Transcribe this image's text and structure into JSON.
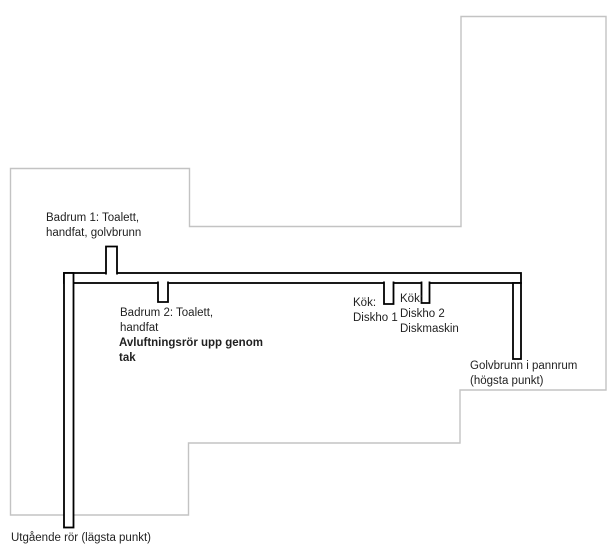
{
  "diagram": {
    "labels": {
      "badrum1": "Badrum 1: Toalett,\nhandfat, golvbrunn",
      "badrum2": "Badrum 2: Toalett,\nhandfat",
      "avluftning": "Avluftningsrör upp genom\ntak",
      "kok_diskho1": "Kök:\nDiskho 1",
      "kok_diskho2": "Kök:\nDiskho 2\nDiskmaskin",
      "golvbrunn_pannrum": "Golvbrunn i pannrum\n(högsta punkt)",
      "utgaende_ror": "Utgående rör (lägsta punkt)"
    },
    "colors": {
      "outline": "#c3c3c3",
      "pipe": "#000000",
      "pipe_fill": "#ffffff",
      "text": "#1f1f1f",
      "background": "#ffffff"
    }
  }
}
